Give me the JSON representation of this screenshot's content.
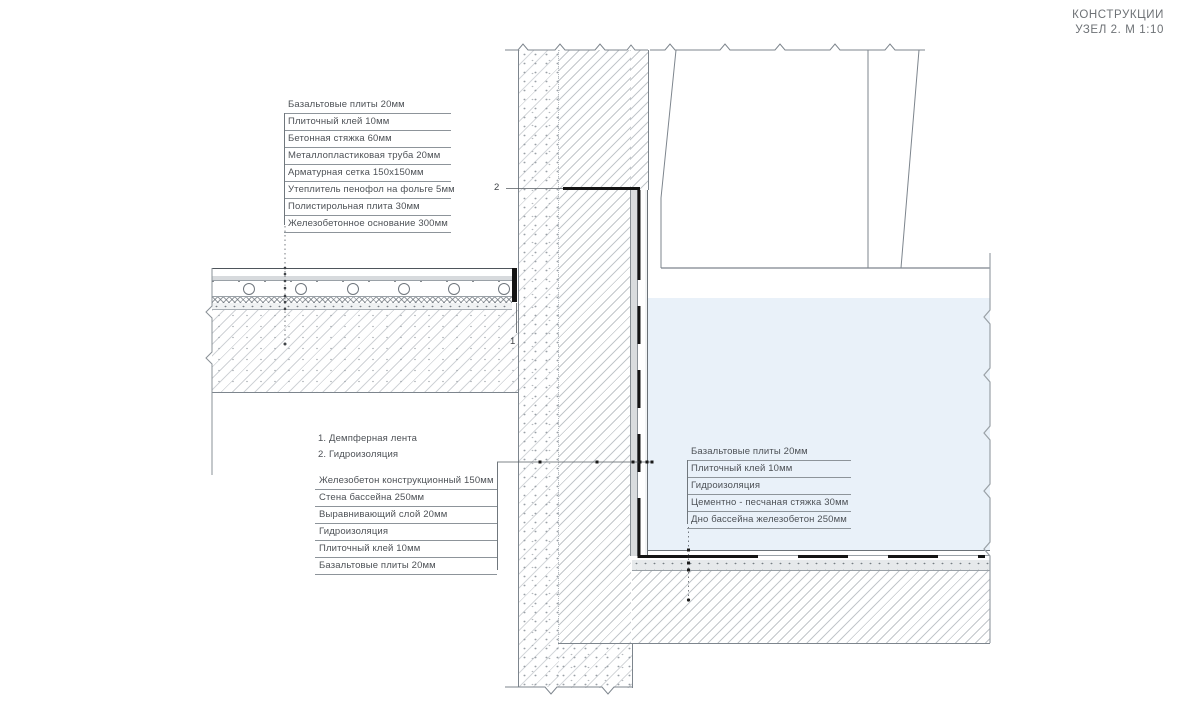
{
  "title": {
    "line1": "КОНСТРУКЦИИ",
    "line2": "УЗЕЛ 2. М 1:10"
  },
  "callouts": {
    "floor_layers": {
      "items": [
        "Базальтовые плиты 20мм",
        "Плиточный клей 10мм",
        "Бетонная стяжка 60мм",
        "Металлопластиковая труба 20мм",
        "Арматурная сетка 150х150мм",
        "Утеплитель пенофол на фольге 5мм",
        "Полистирольная плита 30мм",
        "Железобетонное основание 300мм"
      ]
    },
    "notes": {
      "items": [
        "1. Демпферная лента",
        "2. Гидроизоляция"
      ]
    },
    "wall_layers": {
      "items": [
        "Железобетон конструкционный 150мм",
        "Стена бассейна 250мм",
        "Выравнивающий слой 20мм",
        "Гидроизоляция",
        "Плиточный клей 10мм",
        "Базальтовые плиты 20мм"
      ]
    },
    "pool_bottom_layers": {
      "items": [
        "Базальтовые плиты 20мм",
        "Плиточный клей 10мм",
        "Гидроизоляция",
        "Цементно - песчаная стяжка 30мм",
        "Дно бассейна железобетон 250мм"
      ]
    },
    "marker_1": "1",
    "marker_2": "2"
  },
  "colors": {
    "water": "#e9f1f9",
    "waterproofing": "#141414",
    "hatch_line": "#9199a1",
    "edge_line": "#7d858d",
    "text": "#4d5156"
  }
}
